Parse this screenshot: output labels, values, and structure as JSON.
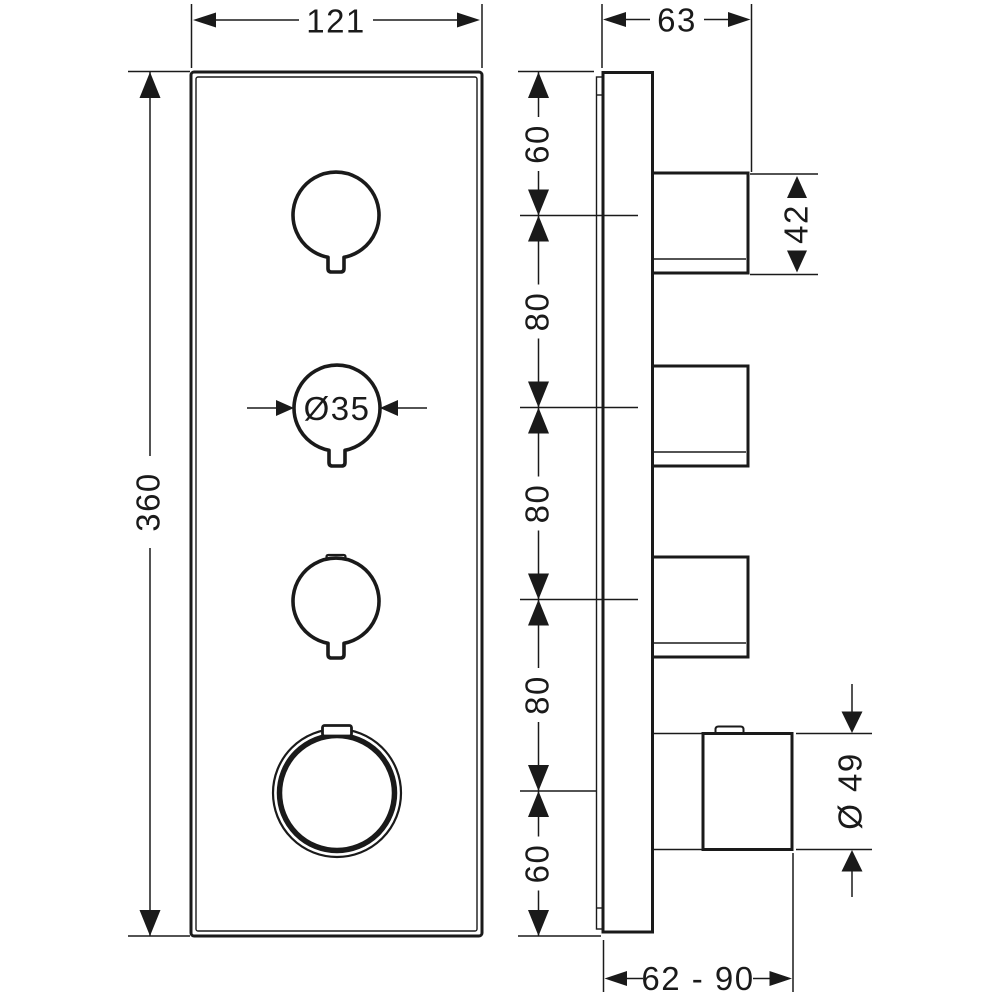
{
  "dimensions": {
    "front_width": "121",
    "front_height": "360",
    "knob_diameter": "Ø35",
    "side_depth": "63",
    "handle_height": "42",
    "spacing_top": "60",
    "spacing_1": "80",
    "spacing_2": "80",
    "spacing_3": "80",
    "spacing_bottom": "60",
    "dial_diameter": "Ø 49",
    "installation_depth_range": "62 - 90"
  }
}
